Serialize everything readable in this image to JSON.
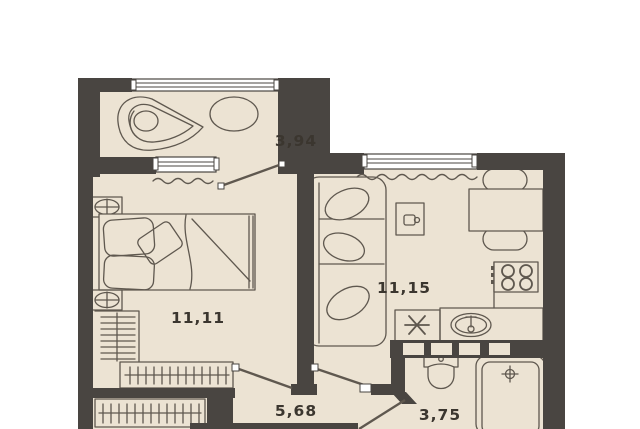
{
  "plan": {
    "type": "apartment-floor-plan",
    "units": "square-meters-with-comma-decimal",
    "rooms": [
      {
        "id": "balcony",
        "area": "3,94",
        "furniture": [
          "corner-chair",
          "oval-table"
        ]
      },
      {
        "id": "living-kitchen",
        "area": "11,15",
        "furniture": [
          "sofa",
          "coffee-table",
          "dining-table",
          "two-chairs",
          "stove",
          "kitchen-counter",
          "sink"
        ]
      },
      {
        "id": "bedroom",
        "area": "11,11",
        "furniture": [
          "double-bed",
          "bedside-lamp",
          "bedside-lamp",
          "wardrobe-rail"
        ]
      },
      {
        "id": "hallway",
        "area": "5,68",
        "furniture": [
          "wardrobe-rail"
        ]
      },
      {
        "id": "bathroom",
        "area": "3,75",
        "furniture": [
          "toilet",
          "bathtub"
        ]
      }
    ]
  },
  "colors": {
    "wall": "#494541",
    "floor": "#ece3d3",
    "line": "#5f584f",
    "label": "#3b362f",
    "window": "#ffffff",
    "background": "#ffffff"
  }
}
